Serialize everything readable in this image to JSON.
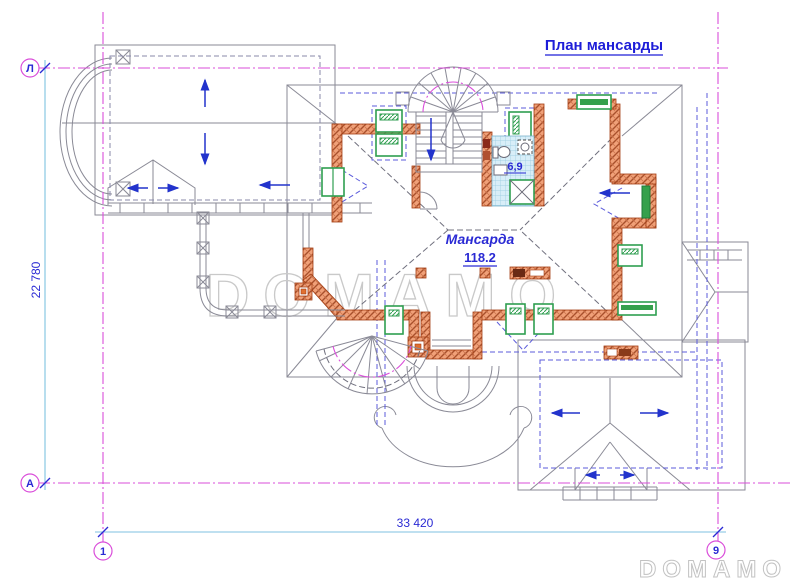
{
  "title": "План мансарды",
  "room": {
    "name": "Мансарда",
    "area": "118.2"
  },
  "bathroom": {
    "area": "6,9"
  },
  "dimensions": {
    "horizontal": "33 420",
    "vertical": "22 780"
  },
  "axis_markers": {
    "row_top": "Л",
    "row_bottom": "А",
    "col_left": "1",
    "col_right": "9"
  },
  "watermark": {
    "center": "DOMAMO",
    "corner": "DOMAMO"
  },
  "colors": {
    "axis_magenta": "#da4eda",
    "dimension_cyan": "#7fc2e0",
    "label_blue": "#1d1dd8",
    "wall_orange": "#f09a6e",
    "wall_border": "#a33d12",
    "window_green": "#2f9e50",
    "roof_gray": "#8a8a96",
    "dashed_blue": "#5b5bdb",
    "tile_blue": "#d8eef8",
    "watermark_gray": "#c9c9c9",
    "arrow_blue": "#2233cc",
    "background": "#ffffff"
  }
}
